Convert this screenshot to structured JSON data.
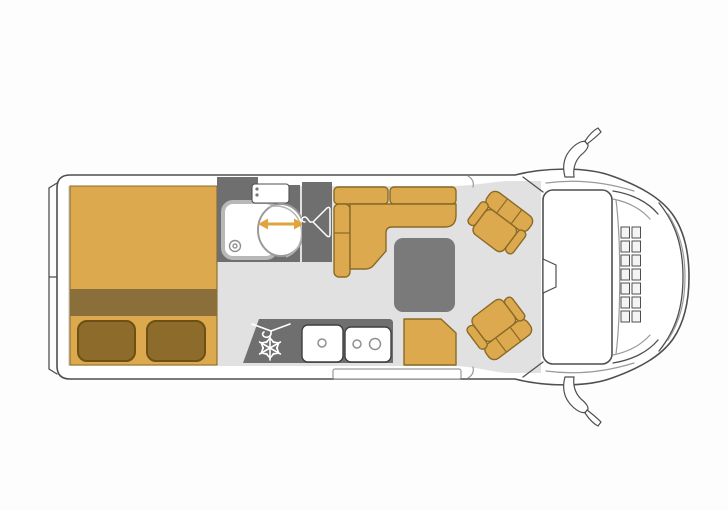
{
  "colors": {
    "background": "#fdfdfd",
    "outline": "#4f4f4f",
    "outline-light": "#9a9a9a",
    "floor": "#e1e1e1",
    "orange": "#dca94f",
    "orange-outline": "#8a6a25",
    "bed-band": "#8b6f3b",
    "pillow": "#8d6b2b",
    "pillow-outline": "#6e5014",
    "gray-dark": "#6f6f6f",
    "table-gray": "#7a7a7a",
    "white": "#ffffff",
    "arrow": "#e2a33c",
    "fixture-outline": "#909090"
  },
  "floorplan": {
    "vehicle_type": "campervan top-view floor plan",
    "areas": {
      "rear_bed": {
        "pillows": 2,
        "sections": [
          "mattress",
          "folded-blanket-band",
          "head-section"
        ]
      },
      "bathroom": {
        "fixtures": [
          "washbasin",
          "shower-tray",
          "swivel-toilet"
        ],
        "toilet_arrow": "double-headed-horizontal"
      },
      "wardrobe": {
        "icon": "coat-hanger"
      },
      "dinette": {
        "bench": "L-shaped",
        "back_cushions": 2,
        "table": 1,
        "side_seat": 1
      },
      "kitchen": {
        "icons": [
          "coat-hanger",
          "snowflake"
        ],
        "sink_bowls": 1,
        "hob_burners": 2
      },
      "cab": {
        "swivel_seats": 2,
        "windshield": 1,
        "rearview_mirror": 1,
        "side_mirrors": 2,
        "grille_columns": 2,
        "grille_rows": 7
      }
    }
  }
}
